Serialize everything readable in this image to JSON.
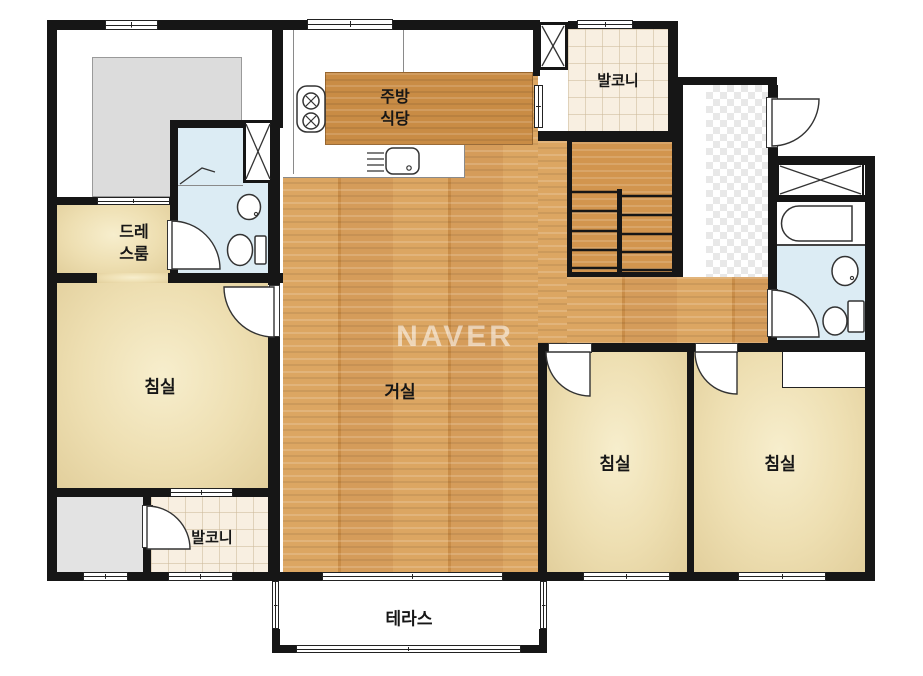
{
  "watermark": "NAVER",
  "labels": {
    "balcony_top": "발코니",
    "kitchen_l1": "주방",
    "kitchen_l2": "식당",
    "dress_l1": "드레",
    "dress_l2": "스룸",
    "bedroom_left": "침실",
    "living": "거실",
    "balcony_bottom": "발코니",
    "bedroom_mid": "침실",
    "bedroom_right": "침실",
    "terrace": "테라스"
  },
  "colors": {
    "wall": "#161616",
    "wood_floor": "#d2954e",
    "bedroom_floor": "#eedfb2",
    "balcony_tile": "#f8efe1",
    "bathroom_blue": "#dcecf4",
    "watermark_white": "#ffffff"
  }
}
